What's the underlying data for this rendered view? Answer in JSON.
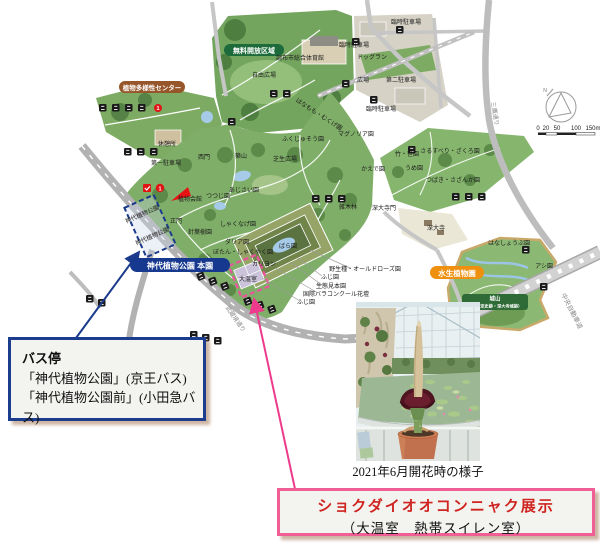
{
  "map": {
    "pills": {
      "free_zone": "無料開放区域",
      "diversity_center": "植物多様性センター",
      "main_garden": "神代植物公園 本園",
      "aquatic_garden": "水生植物園",
      "shiroyama": "城山",
      "shiroyama_sub": "（国指定史跡・深大寺城跡）"
    },
    "labels": {
      "gym": "調布市総合体育館",
      "free_plaza": "自由広場",
      "temp_parking1": "臨時駐車場",
      "temp_parking2": "臨時駐車場",
      "temp_parking3": "臨時駐車場",
      "dog_run": "ドッグラン",
      "plaza": "広場",
      "parking2": "第二駐車場",
      "parking1": "第一駐車場",
      "rest_house": "休憩所",
      "west_gate": "西門",
      "main_gate": "正門",
      "plant_hall": "植物会館",
      "tsutsuji": "つつじ園",
      "tsukiyama": "築山",
      "lawn_plaza": "芝生広場",
      "fukujuso": "ふくじゅそう園",
      "magnolia": "マグノリア園",
      "hanamomo": "はなもも・むくげ園",
      "kaede": "かえで園",
      "zokibayashi": "雑木林",
      "ajisai": "あじさい園",
      "shakunage": "しゃくなげ園",
      "take_sasa": "竹・笹園",
      "jindaiji_gate": "深大寺門",
      "sarusuberi": "さるすべり・ざくろ園",
      "ume": "うめ園",
      "tsubaki": "つばき・さざんか園",
      "jindaiji": "深大寺",
      "hanashobu": "はなしょうぶ園",
      "ashi": "アシ園",
      "rose_garden": "ばら園",
      "carillon": "カリヨン",
      "greenhouse": "大温室",
      "old_rose": "野生種・オールドローズ園",
      "fuji1": "ふじ園",
      "eco_garden": "生態見本園",
      "rose_concours": "国際バラコンクール花壇",
      "fuji2": "ふじ園",
      "dahlia": "ダリア園",
      "botan": "ぼたん・しゃくやく園",
      "conifer": "針葉樹園",
      "bus_stop1": "神代植物公園",
      "bus_stop2": "神代植物公園"
    },
    "roads": {
      "mitaka": "三鷹通り",
      "musashisakai": "武蔵境通り",
      "chuo_expwy": "中央自動車道"
    },
    "compass_n": "N",
    "scale_ticks": [
      "0",
      "20",
      "50",
      "100",
      "150m"
    ]
  },
  "bus_stop_box": {
    "title": "バス停",
    "line1": "「神代植物公園」(京王バス)",
    "line2": "「神代植物公園前」(小田急バス)"
  },
  "photo": {
    "caption": "2021年6月開花時の様子"
  },
  "exhibit_box": {
    "title": "ショクダイオオコンニャク展示",
    "subtitle": "（大温室　熱帯スイレン室）"
  }
}
